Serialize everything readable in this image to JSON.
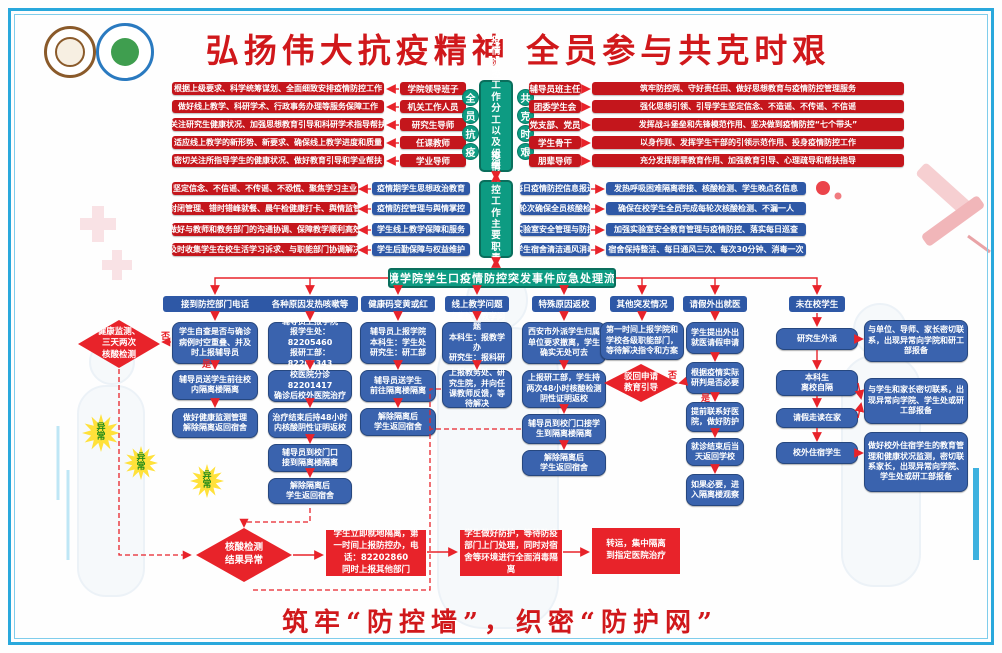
{
  "title": "弘扬伟大抗疫精神 全员参与共克时艰",
  "footer": "筑牢“防控墙”，织密“防护网”",
  "org": {
    "center": "疫情防控工作分工以及组织实施体系",
    "left_motto": [
      "全",
      "员",
      "抗",
      "疫"
    ],
    "right_motto": [
      "共",
      "克",
      "时",
      "艰"
    ],
    "left": [
      {
        "detail": "根据上级要求、科学统筹谋划、全面细致安排疫情防控工作",
        "role": "学院领导班子"
      },
      {
        "detail": "做好线上教学、科研学术、行政事务办理等服务保障工作",
        "role": "机关工作人员"
      },
      {
        "detail": "关注研究生健康状况、加强思想教育引导和科研学术指导帮扶",
        "role": "研究生导师"
      },
      {
        "detail": "适应线上教学的新形势、新要求、确保线上教学进度和质量",
        "role": "任课教师"
      },
      {
        "detail": "密切关注所指导学生的健康状况、做好教育引导和学业帮扶",
        "role": "学业导师"
      }
    ],
    "right": [
      {
        "role": "辅导员班主任",
        "detail": "筑牢防控网、守好责任田、做好思想教育与疫情防控管理服务"
      },
      {
        "role": "团委学生会",
        "detail": "强化思想引领、引导学生坚定信念、不造谣、不传谣、不信谣"
      },
      {
        "role": "党支部、党员",
        "detail": "发挥战斗堡垒和先锋模范作用、坚决做到疫情防控“七个带头”"
      },
      {
        "role": "学生骨干",
        "detail": "以身作则、发挥学生干部的引领示范作用、投身疫情防控工作"
      },
      {
        "role": "朋辈导师",
        "detail": "充分发挥朋辈教育作用、加强教育引导、心理疏导和帮扶指导"
      }
    ]
  },
  "duty": {
    "center": "疫情防控工作主要职责任务",
    "left": [
      {
        "detail": "坚定信念、不信谣、不传谣、不恐慌、聚焦学习主业",
        "label": "疫情期学生思想政治教育"
      },
      {
        "detail": "封闭管理、错时错峰就餐、晨午检健康打卡、舆情监管",
        "label": "疫情防控管理与舆情掌控"
      },
      {
        "detail": "做好与教师和教务部门的沟通协调、保障教学顺利高效",
        "label": "学生线上教学保障和服务"
      },
      {
        "detail": "及时收集学生在校生活学习诉求、与职能部门协调解决",
        "label": "学生后勤保障与权益维护"
      }
    ],
    "right": [
      {
        "label": "每日疫情防控信息报送",
        "detail": "发热呼吸困难隔离密接、核酸检测、学生晚点名信息"
      },
      {
        "label": "每轮次确保全员核酸检测",
        "detail": "确保在校学生全员完成每轮次核酸检测、不漏一人"
      },
      {
        "label": "实验室安全管理与防控",
        "detail": "加强实验室安全教育管理与疫情防控、落实每日巡查"
      },
      {
        "label": "学生宿舍清洁通风消毒",
        "detail": "宿舍保持整洁、每日通风三次、每次30分钟、消毒一次"
      }
    ]
  },
  "flow": {
    "banner": "环境学院学生口疫情防控突发事件应急处理流程",
    "headers": [
      "接到防控部门电话",
      "各种原因发热咳嗽等",
      "健康码变黄或红",
      "线上教学问题",
      "特殊原因返校",
      "其他突发情况",
      "请假外出就医",
      "未在校学生"
    ],
    "yes": "是",
    "no": "否",
    "c1": {
      "d": "健康监测、\n三天两次\n核酸检测",
      "b1": "学生自查是否与确诊病例时空重叠、并及时上报辅导员",
      "b2": "辅导员送学生前往校内隔离楼隔离",
      "b3": "做好健康监测管理\n解除隔离返回宿舍"
    },
    "c2": {
      "b1": "辅导员上报学院\n报学生处：82205460\n报研工部：82205343",
      "b2": "校医院分诊82201417\n确诊后校外医院治疗",
      "b3": "治疗结束后持48小时内核酸阴性证明返校",
      "b4": "辅导员到校门口\n接到隔离楼隔离",
      "b5": "解除隔离后\n学生返回宿舍"
    },
    "c3": {
      "b1": "辅导员上报学院\n本科生：学生处\n研究生：研工部",
      "b2": "辅导员送学生\n前往隔离楼隔离",
      "b3": "解除隔离后\n学生返回宿舍"
    },
    "c4": {
      "b1": "收集线上教学问题\n本科生：报教学办\n研究生：报科研办",
      "b2": "上报教务处、研究生院，并向任课教师反馈，等待解决"
    },
    "c5": {
      "b1": "西安市外派学生归属单位要求撤离，学生确实无处可去",
      "b2": "上报研工部，学生持两次48小时核酸检测阴性证明返校",
      "b3": "辅导员到校门口接学生到隔离楼隔离",
      "b4": "解除隔离后\n学生返回宿舍"
    },
    "c6": {
      "b1": "第一时间上报学院和学校各级职能部门，等待解决指令和方案",
      "d": "驳回申请\n教育引导"
    },
    "c7": {
      "b1": "学生提出外出就医请假申请",
      "b2": "根据疫情实际研判是否必要",
      "b3": "提前联系好医院，做好防护",
      "b4": "就诊结束后当天返回学校",
      "b5": "如果必要，进入隔离楼观察"
    },
    "c8": {
      "s1": "研究生外派",
      "s2": "本科生\n离校自隔",
      "s3": "请假走读在家",
      "s4": "校外住宿学生",
      "o1": "与单位、导师、家长密切联系，出现异常向学院和研工部报备",
      "o2": "与学生和家长密切联系，出现异常向学院、学生处或研工部报备",
      "o3": "做好校外住宿学生的教育管理和健康状况监测，密切联系家长，出现异常向学院、学生处或研工部报备"
    }
  },
  "alert": {
    "star": "异\n常",
    "diamond": "核酸检测\n结果异常",
    "b1": "学生立即就地隔离，第一时间上报防控办，电话：82202860\n同时上报其他部门",
    "b2": "学生做好防护，等待防疫部门上门处理，同时对宿舍等环境进行全面消毒隔离",
    "b3": "转运，集中隔离\n到指定医院治疗"
  }
}
